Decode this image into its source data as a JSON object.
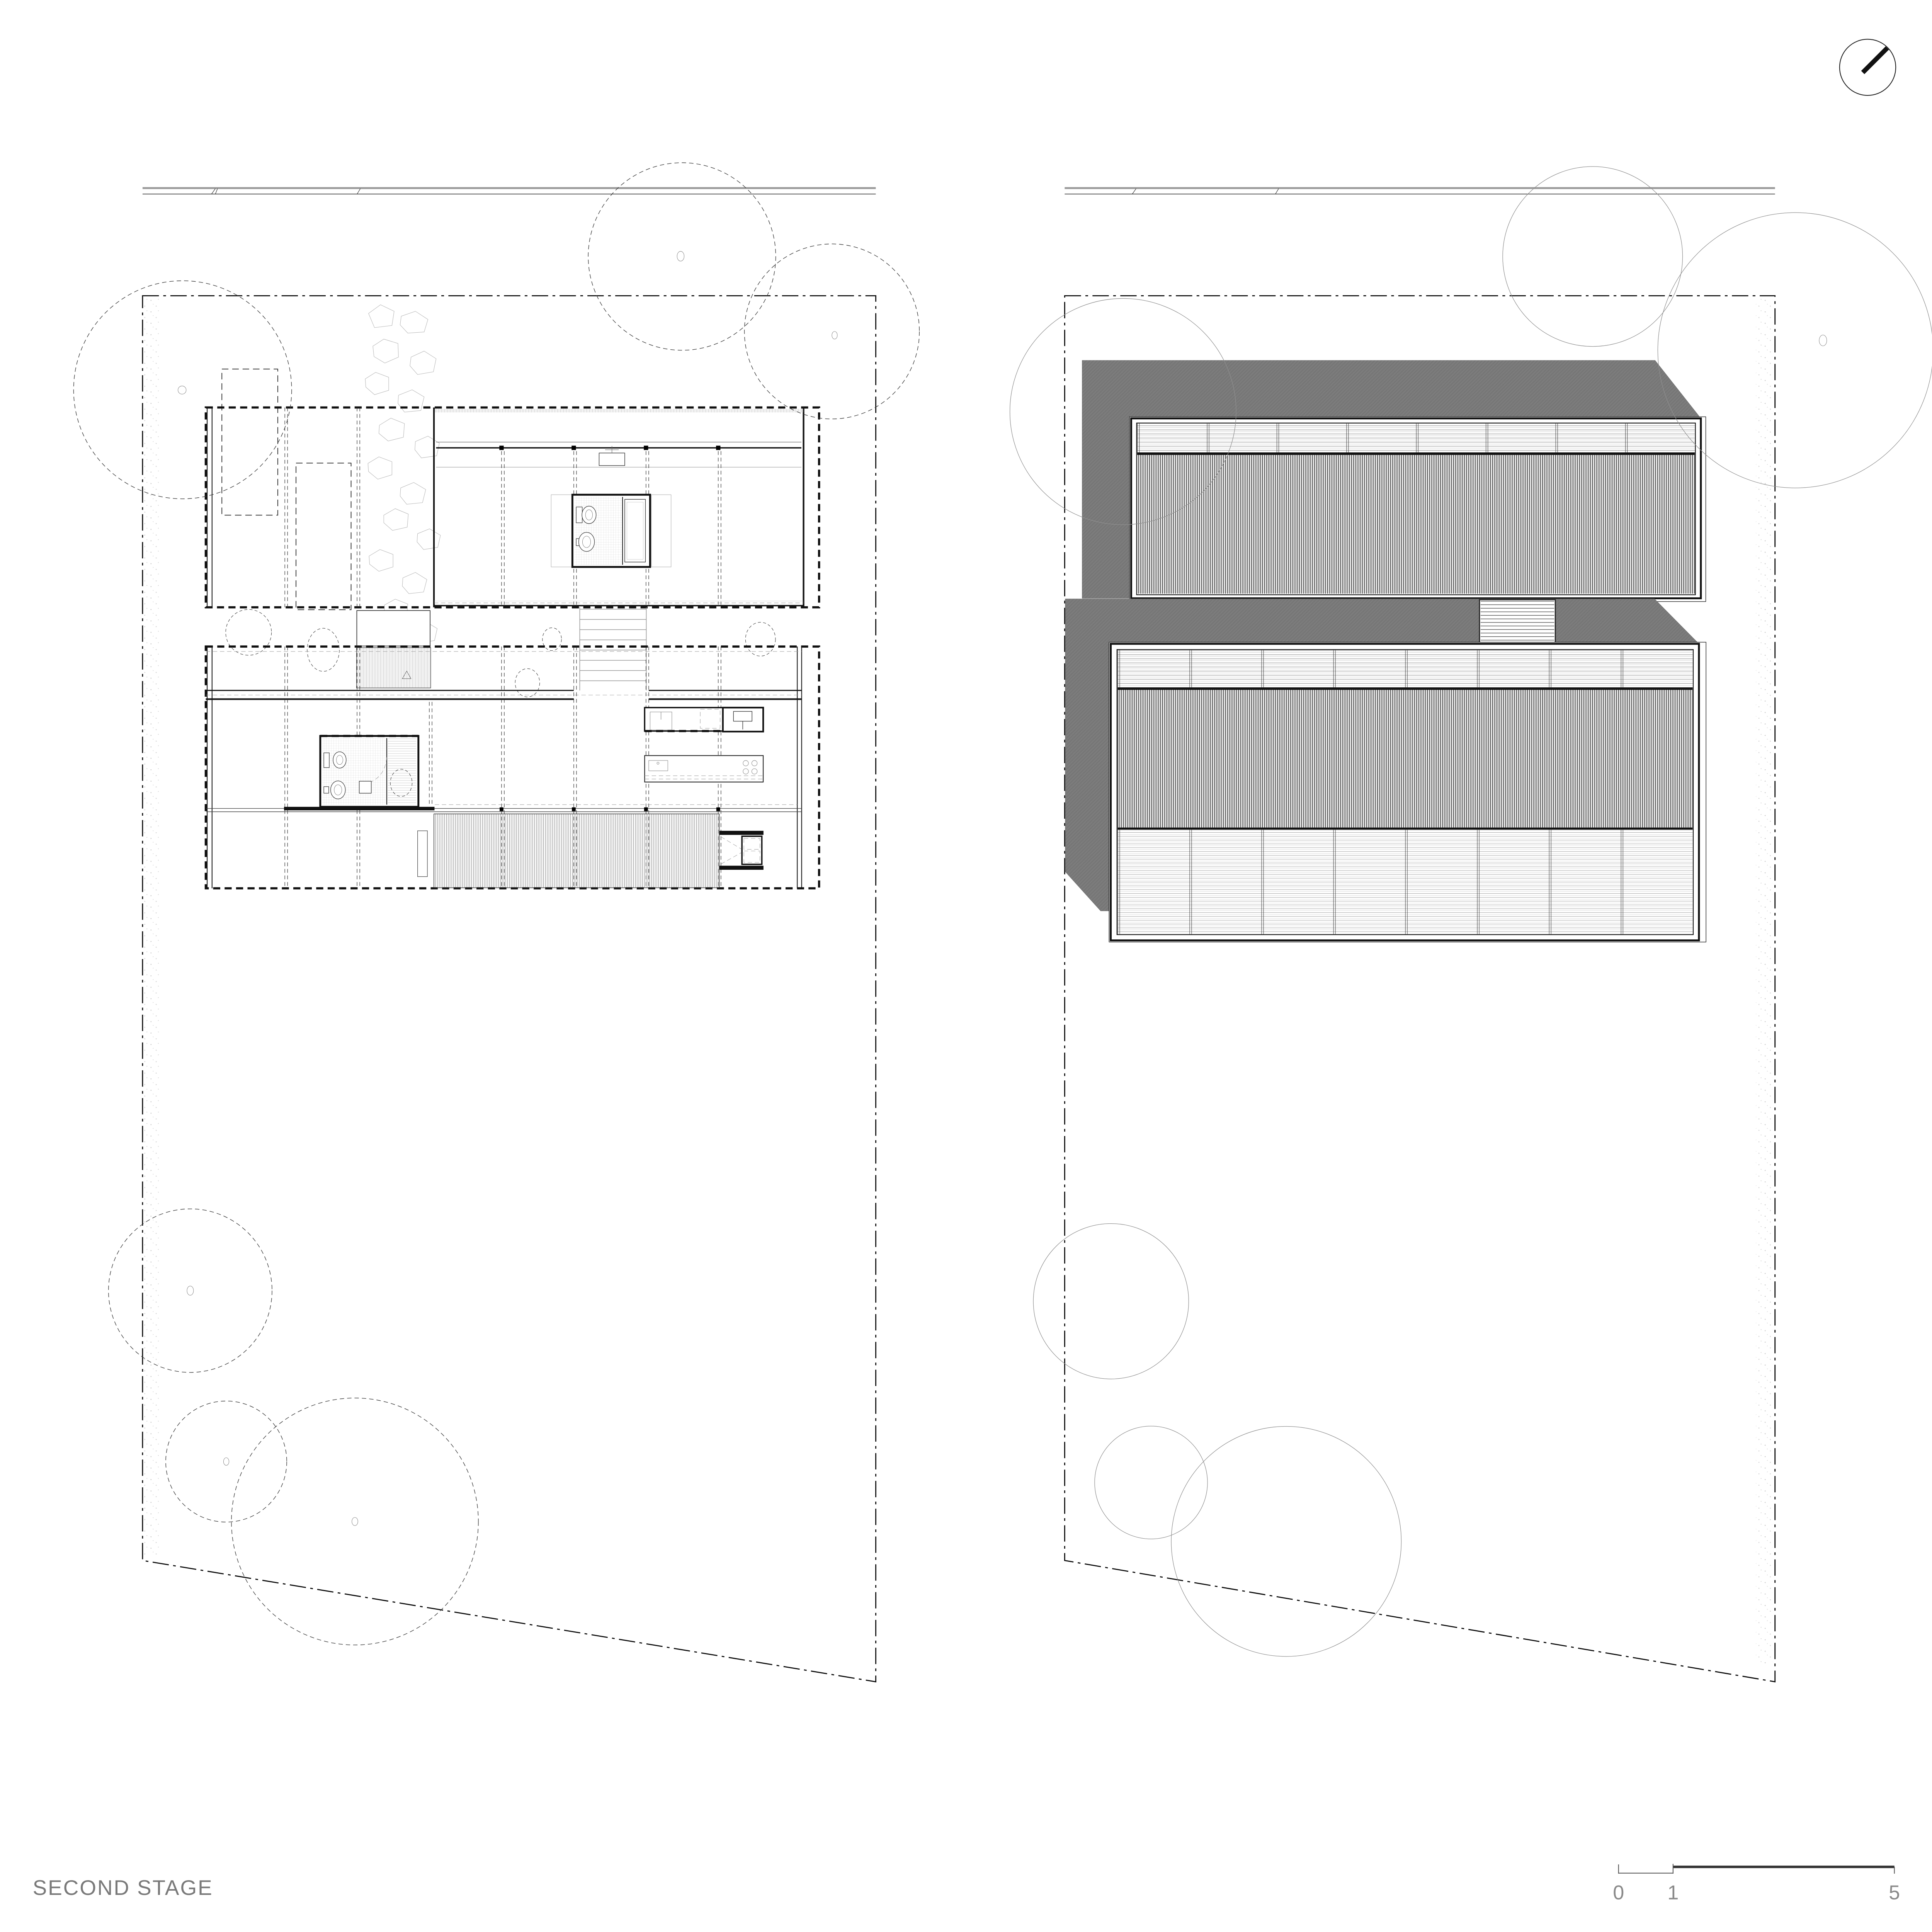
{
  "page": {
    "title_label": "SECOND STAGE",
    "background": "#ffffff"
  },
  "scale_bar": {
    "zero": "0",
    "one": "1",
    "five": "5"
  },
  "colors": {
    "ink": "#141414",
    "roof_shadow_gray": "#7c7c7c",
    "title_gray": "#7a7a7a",
    "scale_gray": "#8a8a8a",
    "street_gray": "#9a9a9a",
    "stone_outline_gray": "#b9b9b9"
  },
  "icons": {
    "north_arrow": "north-arrow-icon"
  }
}
